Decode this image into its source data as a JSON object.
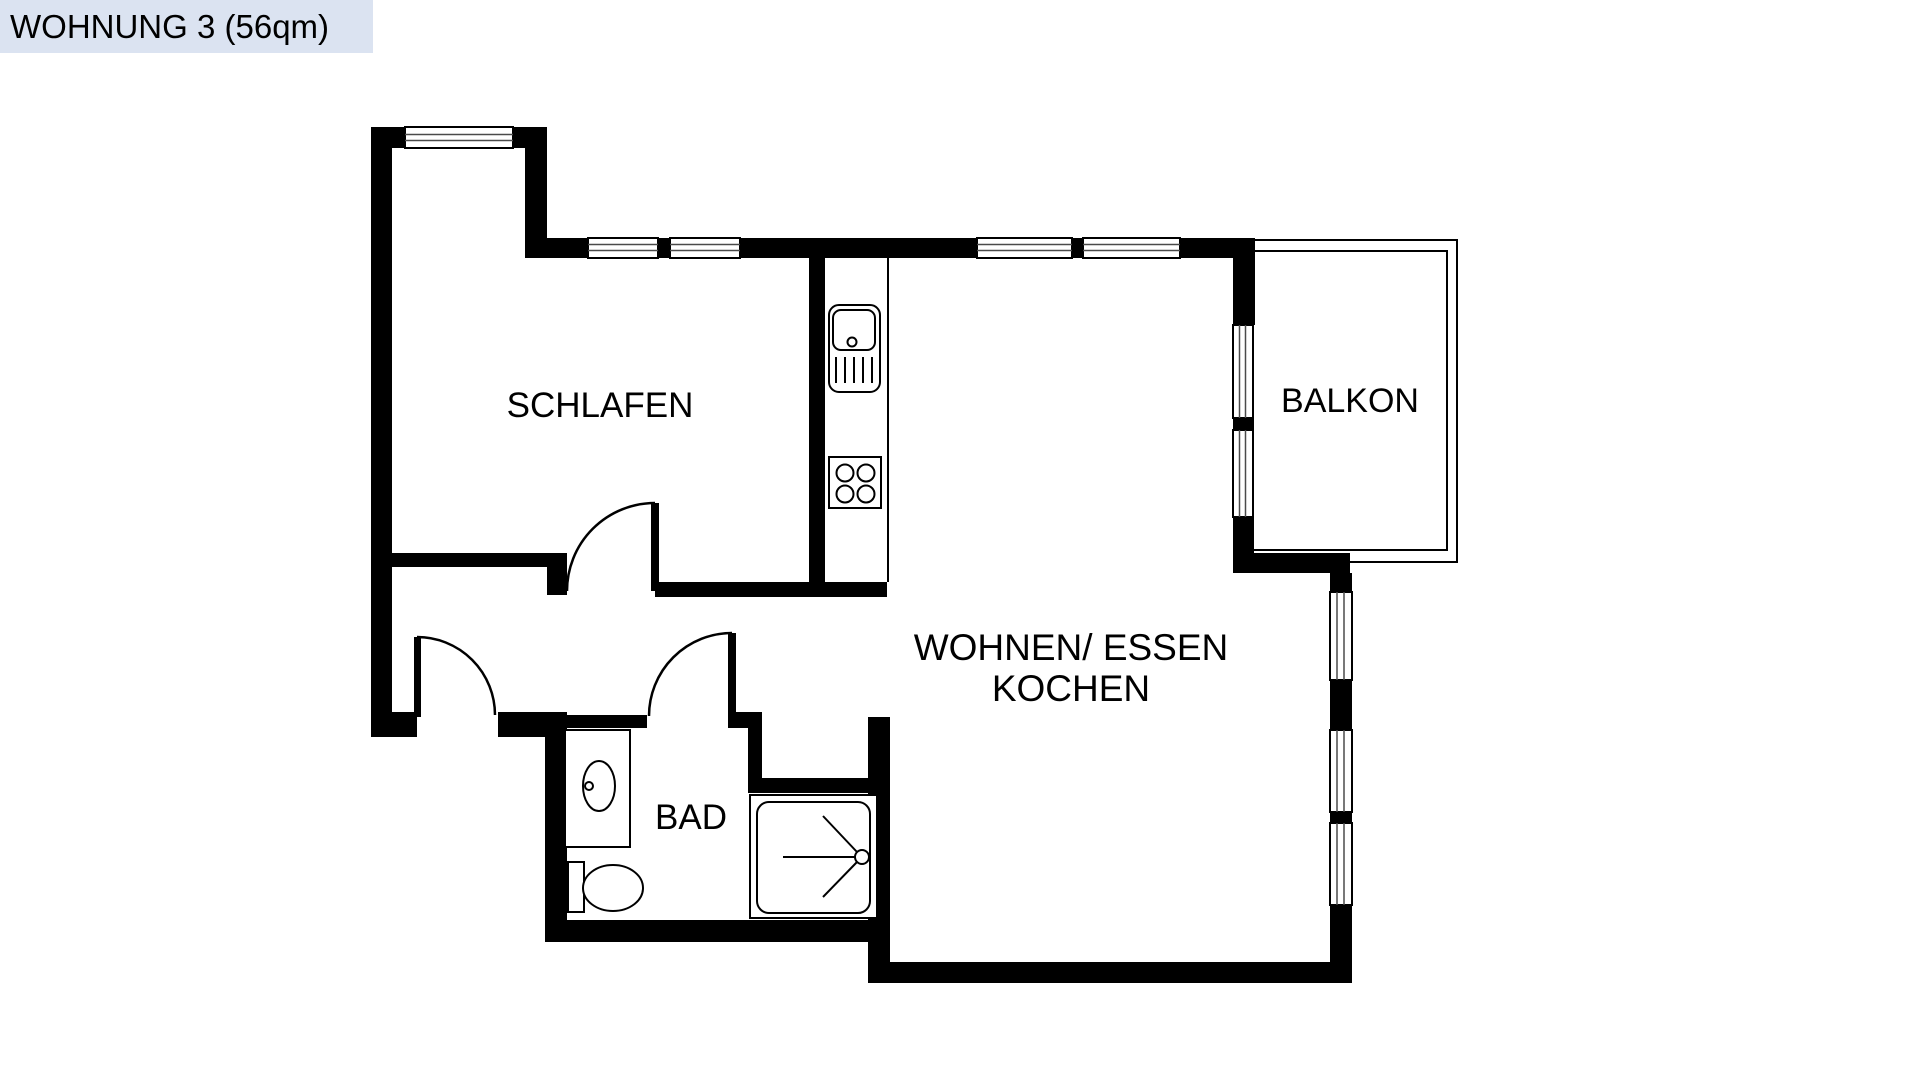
{
  "title": {
    "label": "WOHNUNG 3 (56qm)"
  },
  "rooms": {
    "bedroom": {
      "label": "SCHLAFEN"
    },
    "living": {
      "label_line1": "WOHNEN/ ESSEN",
      "label_line2": "KOCHEN"
    },
    "balcony": {
      "label": "BALKON"
    },
    "bathroom": {
      "label": "BAD"
    }
  },
  "fixtures": {
    "kitchen_sink": "kitchen-sink-icon",
    "stove": "stove-burners-icon",
    "washbasin": "washbasin-icon",
    "toilet": "toilet-icon",
    "shower": "shower-icon"
  },
  "colors": {
    "wall": "#000000",
    "title_bg": "#dbe3f1",
    "paper": "#ffffff"
  }
}
